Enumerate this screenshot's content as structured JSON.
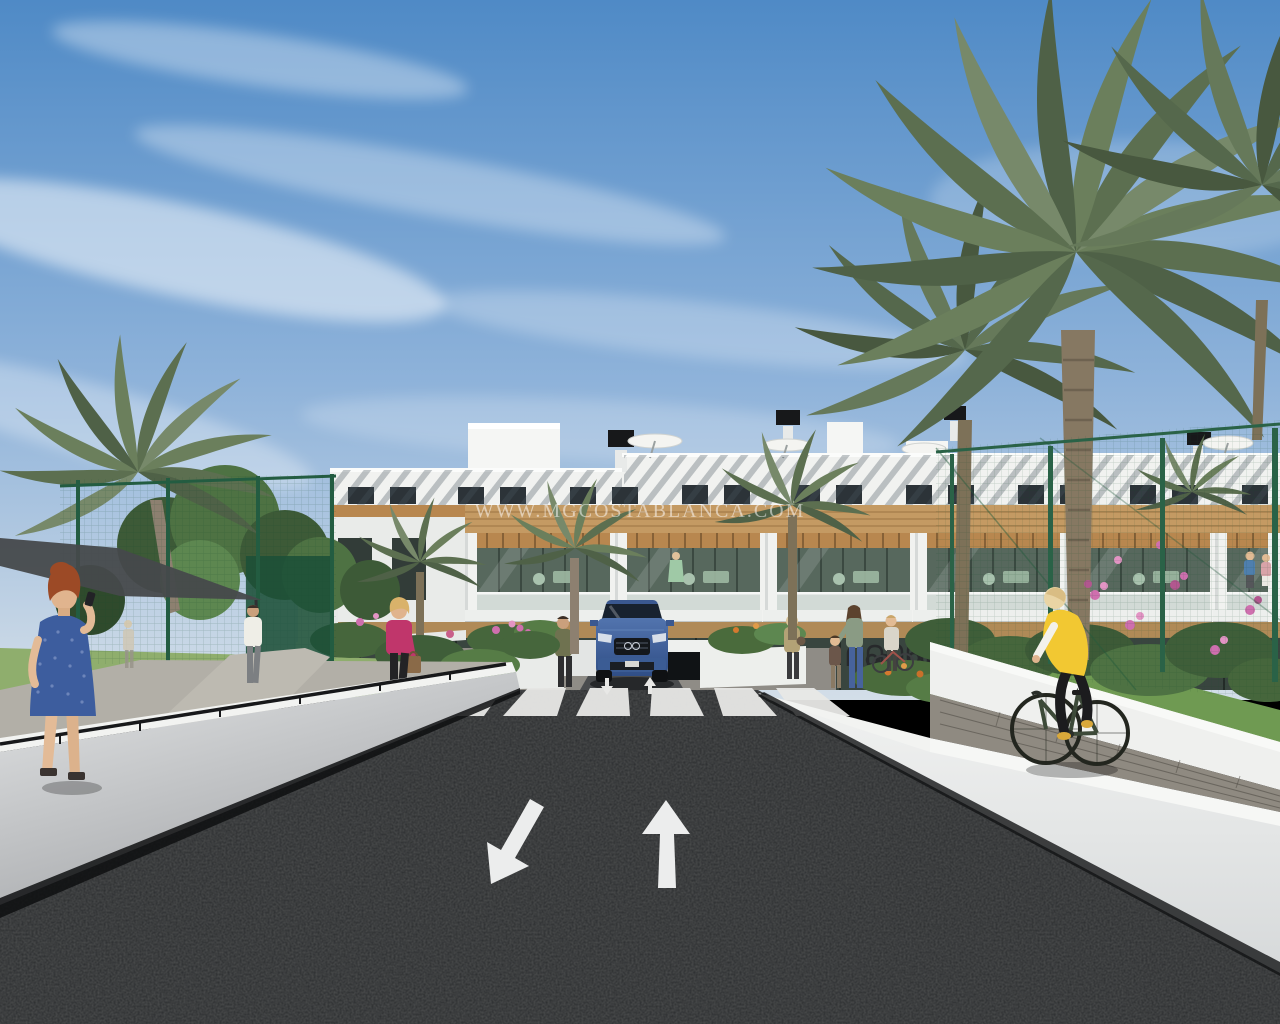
{
  "image": {
    "kind": "3d-architectural-render",
    "watermark": "WWW.MGCOSTABLANCA.COM",
    "scene": "Street view render of a modern white apartment complex with timber accents, palm trees, landscaped gardens, a two-way access road with crosswalk and lane arrows, an underground parking ramp with a blue SUV, pedestrians and a cyclist in a yellow vest"
  },
  "road_markings": {
    "arrow_away_direction": "up",
    "arrow_toward_viewer_direction": "down-left",
    "crosswalk_stripes": 6
  },
  "palette": {
    "sky_top": "#4f8ac6",
    "sky_horizon": "#d3dee8",
    "cloud": "#ffffff",
    "building_white": "#f1f2f0",
    "timber": "#c49a63",
    "glass_dark": "#2c3338",
    "balcony_glass": "#57685d",
    "fence_green": "#2a6247",
    "foliage_dark": "#3d5a37",
    "foliage_light": "#5d8750",
    "palm_frond": "#6b7f5c",
    "palm_trunk": "#867862",
    "grass": "#6f9a52",
    "asphalt": "#2a2c2e",
    "road_marking": "#eceded",
    "wall_white": "#eef0f0",
    "pavement_grey": "#8f8a81",
    "car_blue": "#47699f",
    "vest_yellow": "#f2c832",
    "dress_blue": "#3d5d9e",
    "jacket_pink": "#c0366b",
    "flower_pink": "#cf6fae",
    "flower_orange": "#d4792f"
  }
}
